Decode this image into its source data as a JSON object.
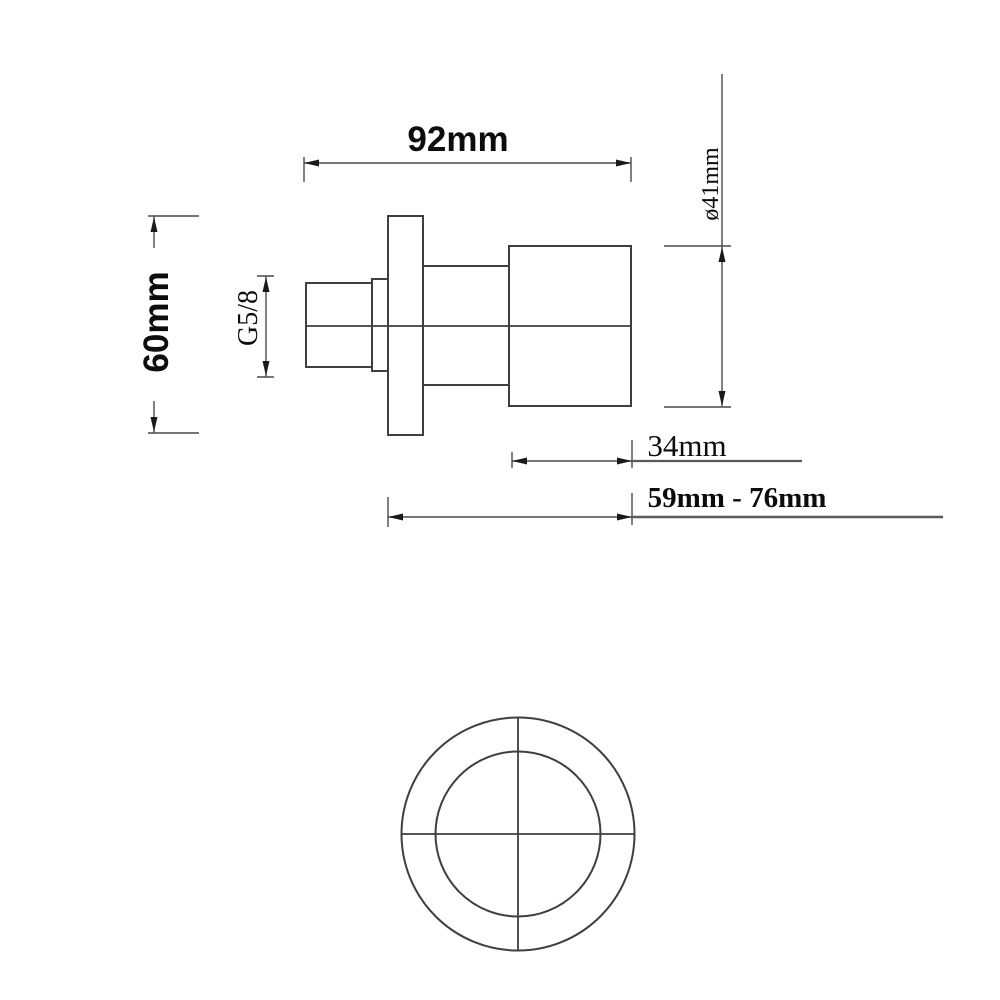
{
  "drawing": {
    "labels": {
      "overall_length": "92mm",
      "flange_height": "60mm",
      "thread_size": "G5/8",
      "handle_diameter": "ø41mm",
      "handle_length": "34mm",
      "mounting_depth_range": "59mm - 76mm"
    },
    "colors": {
      "outline": "#3f3f3f",
      "dimension_line": "#4a4a4a",
      "text": "#0d0d0d",
      "background": "#ffffff"
    }
  }
}
